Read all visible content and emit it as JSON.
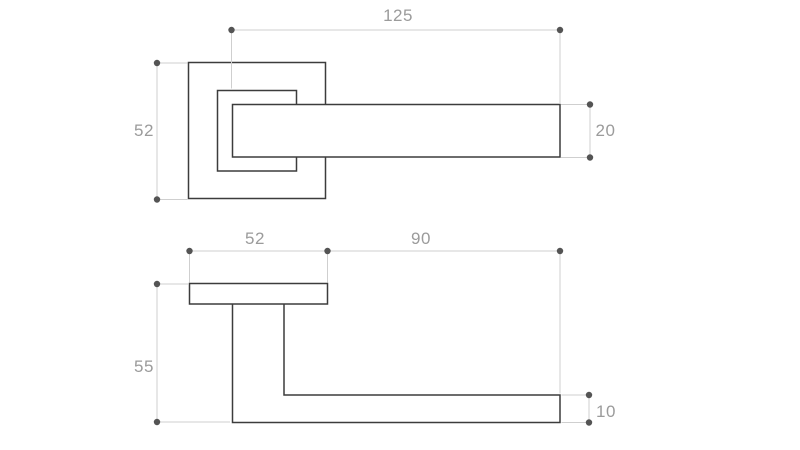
{
  "colors": {
    "background": "#ffffff",
    "part_outline": "#3c3c3c",
    "dimension_line": "#cfcfcf",
    "dimension_marker": "#545454",
    "dimension_text": "#9b9b9b"
  },
  "dimensions": {
    "front_view": {
      "lever_length": "125",
      "rose_size": "52",
      "lever_height": "20"
    },
    "side_view": {
      "rose_size": "52",
      "projection": "90",
      "depth": "55",
      "lever_thickness": "10"
    }
  }
}
